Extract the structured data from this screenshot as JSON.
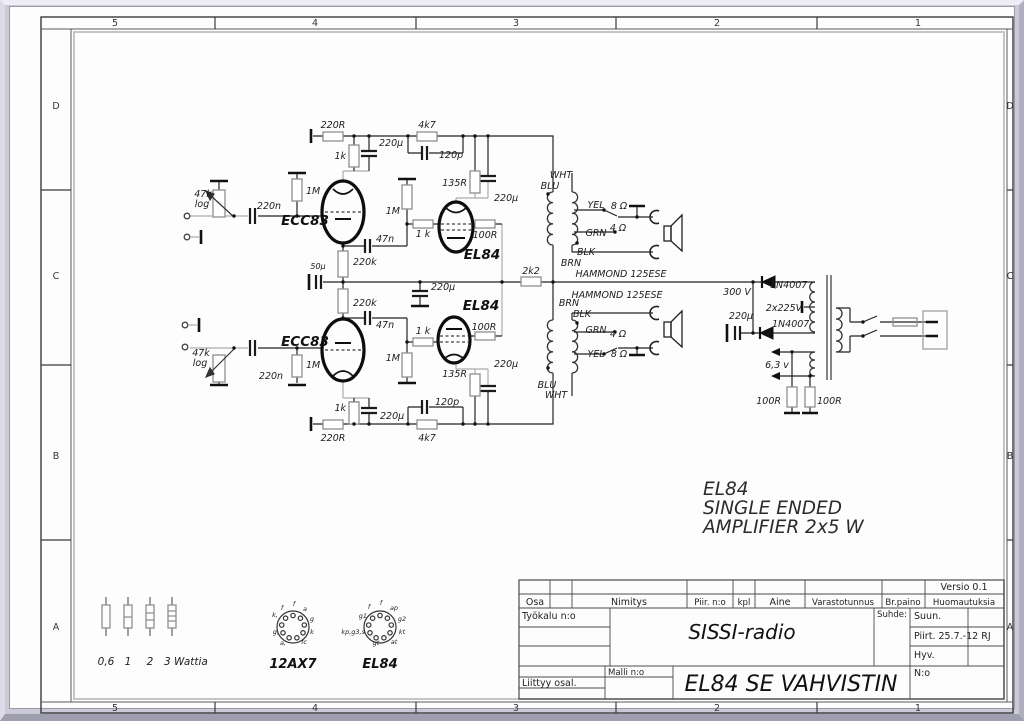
{
  "title_block": {
    "versio": "Versio 0.1",
    "osa": "Osa",
    "nimitys": "Nimitys",
    "piir_no": "Piir. n:o",
    "kpl": "kpl",
    "aine": "Aine",
    "varastotunnus": "Varastotunnus",
    "br_paino": "Br.paino",
    "huomautuksia": "Huomautuksia",
    "tyokalu": "Työkalu n:o",
    "project": "SISSI-radio",
    "suhde": "Suhde:",
    "suun": "Suun.",
    "piirt": "Piirt. 25.7.-12",
    "piirt_initials": "RJ",
    "hyv": "Hyv.",
    "malli": "Malli n:o",
    "liittyy": "Liittyy osal.",
    "title": "EL84 SE VAHVISTIN",
    "no": "N:o"
  },
  "labels": {
    "zones": [
      [
        "5",
        110,
        21
      ],
      [
        "4",
        310,
        21
      ],
      [
        "3",
        511,
        21
      ],
      [
        "2",
        712,
        21
      ],
      [
        "1",
        913,
        21
      ],
      [
        "5",
        110,
        706
      ],
      [
        "4",
        310,
        706
      ],
      [
        "3",
        511,
        706
      ],
      [
        "2",
        712,
        706
      ],
      [
        "1",
        913,
        706
      ],
      [
        "D",
        51,
        104
      ],
      [
        "C",
        51,
        274
      ],
      [
        "B",
        51,
        454
      ],
      [
        "A",
        51,
        625
      ],
      [
        "D",
        1005,
        104
      ],
      [
        "C",
        1005,
        274
      ],
      [
        "B",
        1005,
        454
      ],
      [
        "A",
        1005,
        625
      ]
    ],
    "components": [
      [
        "47k",
        198,
        192
      ],
      [
        "log",
        197,
        202
      ],
      [
        "220n",
        264,
        204
      ],
      [
        "1M",
        301,
        189,
        "start"
      ],
      [
        "ECC83",
        300,
        220,
        "middle",
        "tube"
      ],
      [
        "220R",
        328,
        123
      ],
      [
        "1k",
        341,
        154,
        "end"
      ],
      [
        "220µ",
        374,
        141,
        "start"
      ],
      [
        "4k7",
        422,
        123
      ],
      [
        "120p",
        434,
        153,
        "start"
      ],
      [
        "47n",
        371,
        237,
        "start"
      ],
      [
        "220k",
        348,
        260,
        "start"
      ],
      [
        "1 k",
        418,
        232
      ],
      [
        "1M",
        395,
        209,
        "end"
      ],
      [
        "135R",
        462,
        181,
        "end"
      ],
      [
        "220µ",
        489,
        196,
        "start"
      ],
      [
        "100R",
        480,
        233
      ],
      [
        "EL84",
        477,
        254,
        "middle",
        "tube"
      ],
      [
        "WHT",
        556,
        173
      ],
      [
        "BLU",
        545,
        184
      ],
      [
        "YEL",
        591,
        203
      ],
      [
        "8 Ω",
        614,
        204
      ],
      [
        "GRN",
        591,
        231
      ],
      [
        "4 Ω",
        613,
        226
      ],
      [
        "BLK",
        581,
        250
      ],
      [
        "BRN",
        566,
        261
      ],
      [
        "2k2",
        526,
        269
      ],
      [
        "HAMMOND 125ESE",
        616,
        272
      ],
      [
        "50µ",
        313,
        264,
        "middle",
        "sm"
      ],
      [
        "220µ",
        426,
        285,
        "start"
      ],
      [
        "220k",
        348,
        301,
        "start"
      ],
      [
        "HAMMOND 125ESE",
        612,
        293
      ],
      [
        "300 V",
        732,
        290
      ],
      [
        "1N4007",
        765,
        283,
        "start"
      ],
      [
        "2x225V",
        779,
        306
      ],
      [
        "220µ",
        736,
        314
      ],
      [
        "1N4007",
        767,
        322,
        "start"
      ],
      [
        "6,3 v",
        772,
        363
      ],
      [
        "100R",
        776,
        399,
        "end"
      ],
      [
        "100R",
        812,
        399,
        "start"
      ],
      [
        "ECC83",
        300,
        341,
        "middle",
        "tube"
      ],
      [
        "EL84",
        476,
        305,
        "middle",
        "tube"
      ],
      [
        "47k",
        196,
        351
      ],
      [
        "log",
        195,
        361
      ],
      [
        "220n",
        266,
        374
      ],
      [
        "1M",
        301,
        363,
        "start"
      ],
      [
        "47n",
        371,
        323,
        "start"
      ],
      [
        "1 k",
        418,
        329
      ],
      [
        "1M",
        395,
        356,
        "end"
      ],
      [
        "100R",
        479,
        325
      ],
      [
        "135R",
        462,
        372,
        "end"
      ],
      [
        "220µ",
        489,
        362,
        "start"
      ],
      [
        "BRN",
        564,
        301
      ],
      [
        "BLK",
        577,
        312
      ],
      [
        "GRN",
        591,
        328
      ],
      [
        "4 Ω",
        613,
        332
      ],
      [
        "YEL",
        591,
        352
      ],
      [
        "8 Ω",
        614,
        352
      ],
      [
        "BLU",
        542,
        383
      ],
      [
        "WHT",
        551,
        393
      ],
      [
        "1k",
        341,
        406,
        "end"
      ],
      [
        "220µ",
        375,
        414,
        "start"
      ],
      [
        "120p",
        430,
        400,
        "start"
      ],
      [
        "220R",
        328,
        436
      ],
      [
        "4k7",
        422,
        436
      ]
    ],
    "anno": [
      [
        "EL84",
        698,
        490,
        "start"
      ],
      [
        "SINGLE ENDED",
        698,
        509,
        "start"
      ],
      [
        "AMPLIFIER 2x5 W",
        698,
        528,
        "start"
      ]
    ],
    "legend": [
      [
        "0,6",
        101,
        660
      ],
      [
        "1",
        123,
        660
      ],
      [
        "2",
        145,
        660
      ],
      [
        "3 Wattia",
        159,
        660,
        "start"
      ]
    ],
    "tubename": [
      [
        "12AX7",
        288,
        663
      ],
      [
        "EL84",
        375,
        663
      ]
    ],
    "pins": [
      [
        "f",
        277,
        605
      ],
      [
        "f",
        289,
        601
      ],
      [
        "a",
        300,
        606
      ],
      [
        "g",
        307,
        616
      ],
      [
        "k",
        307,
        629
      ],
      [
        "fc",
        299,
        639
      ],
      [
        "a,",
        278,
        640
      ],
      [
        "g,",
        274,
        629,
        "end"
      ],
      [
        "k,",
        273,
        612,
        "end"
      ],
      [
        "f",
        364,
        604
      ],
      [
        "f",
        376,
        600
      ],
      [
        "ap",
        389,
        605
      ],
      [
        "g2",
        397,
        616
      ],
      [
        "kt",
        397,
        629
      ],
      [
        "at",
        389,
        639
      ],
      [
        "gt",
        371,
        640
      ],
      [
        "kp,g3,s",
        360,
        629,
        "end"
      ],
      [
        "g1",
        362,
        613,
        "end"
      ]
    ]
  }
}
